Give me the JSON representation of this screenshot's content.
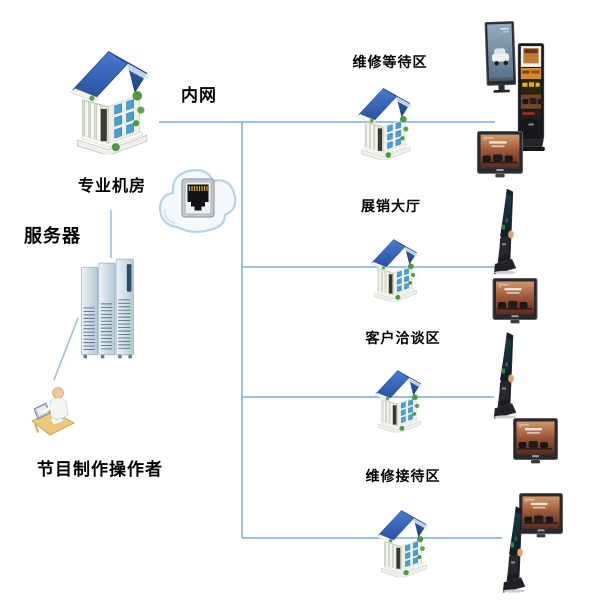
{
  "diagram": {
    "labels": {
      "intranet": "内网",
      "server_room": "专业机房",
      "server": "服务器",
      "operator": "节目制作操作者"
    },
    "zones": [
      {
        "label": "维修等待区"
      },
      {
        "label": "展销大厅"
      },
      {
        "label": "客户洽谈区"
      },
      {
        "label": "维修接待区"
      }
    ],
    "icon_names": [
      "office-building-icon",
      "cloud-network-icon",
      "ethernet-port-icon",
      "server-rack-icon",
      "operator-at-desk-icon",
      "portrait-monitor-icon",
      "signage-kiosk-totem-icon",
      "angled-signage-kiosk-icon",
      "wall-display-icon"
    ],
    "colors": {
      "connection_line": "#9ebfde",
      "building_roof": "#2e5cb0",
      "label_text": "#000000",
      "cloud_fill": "#f3f9fd",
      "kiosk_frame": "#17181c",
      "server_tower": "#cfe0e8",
      "ethernet_pins": "#d8a224"
    }
  }
}
